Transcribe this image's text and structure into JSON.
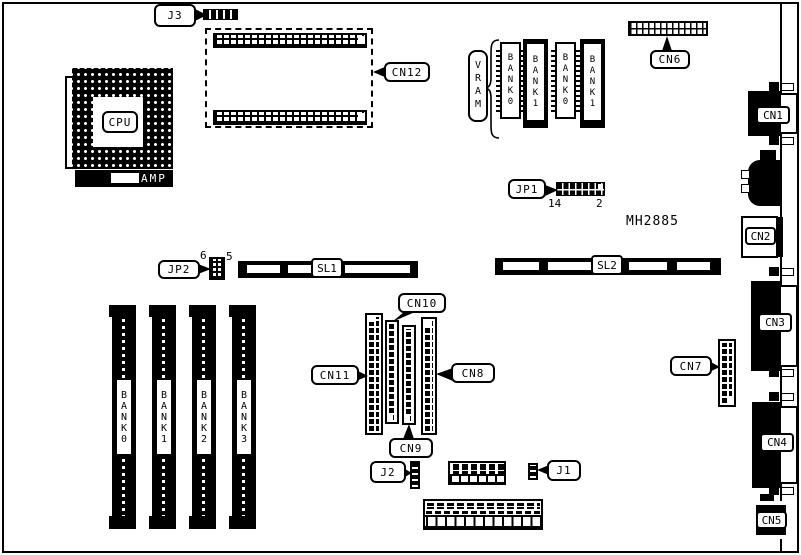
{
  "board": {
    "part_number": "MH2885",
    "cpu": {
      "label": "CPU",
      "amp_label": "AMP"
    },
    "connectors": {
      "j1": "J1",
      "j2": "J2",
      "j3": "J3",
      "cn1": "CN1",
      "cn2": "CN2",
      "cn3": "CN3",
      "cn4": "CN4",
      "cn5": "CN5",
      "cn6": "CN6",
      "cn7": "CN7",
      "cn8": "CN8",
      "cn9": "CN9",
      "cn10": "CN10",
      "cn11": "CN11",
      "cn12": "CN12"
    },
    "jumpers": {
      "jp1": {
        "label": "JP1",
        "pin_left": "14",
        "pin_right": "2"
      },
      "jp2": {
        "label": "JP2",
        "pin_left": "6",
        "pin_right": "5"
      }
    },
    "slots": {
      "sl1": "SL1",
      "sl2": "SL2"
    },
    "vram": {
      "label": "VRAM",
      "chips": [
        {
          "label": "BANK0"
        },
        {
          "label": "BANK1"
        },
        {
          "label": "BANK0"
        },
        {
          "label": "BANK1"
        }
      ]
    },
    "simm": {
      "banks": [
        {
          "label": "BANK0"
        },
        {
          "label": "BANK1"
        },
        {
          "label": "BANK2"
        },
        {
          "label": "BANK3"
        }
      ]
    },
    "colors": {
      "ink": "#000000",
      "paper": "#ffffff"
    }
  }
}
